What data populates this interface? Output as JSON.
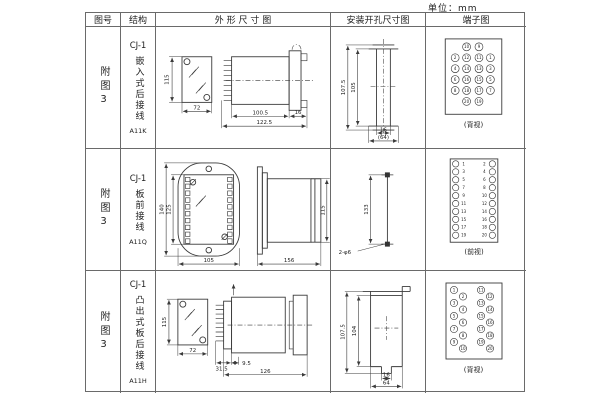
{
  "unit_label": "单位：mm",
  "header": {
    "figure": "图号",
    "structure": "结构",
    "outline": "外 形 尺 寸 图",
    "mounting": "安装开孔尺寸图",
    "terminal": "端子图"
  },
  "rows": [
    {
      "figure": "附图3",
      "model": "CJ-1",
      "desc": "嵌入式后接线",
      "code": "A11K",
      "outline": {
        "h": "115",
        "w": "72",
        "body": "100.5",
        "flange": "16",
        "total": "122.5"
      },
      "mounting": {
        "outer": "107.5",
        "inner": "105",
        "slot": "16",
        "overall": "(64)"
      },
      "terminal": {
        "label": "(背视)",
        "outer_left": [
          "2",
          "4",
          "6",
          "8"
        ],
        "inner_left": [
          "10",
          "12",
          "14",
          "16",
          "18",
          "20"
        ],
        "inner_right": [
          "9",
          "11",
          "13",
          "15",
          "17",
          "19"
        ],
        "outer_right": [
          "1",
          "3",
          "5",
          "7"
        ]
      }
    },
    {
      "figure": "附图3",
      "model": "CJ-1",
      "desc": "板前接线",
      "code": "A11Q",
      "outline": {
        "h": "140",
        "inner": "125",
        "w": "105",
        "len": "156",
        "side_h": "115"
      },
      "mounting": {
        "span": "133",
        "holes": "2-φ6"
      },
      "terminal": {
        "label": "(前视)",
        "left": [
          "1",
          "3",
          "5",
          "7",
          "9",
          "11",
          "13",
          "15",
          "17",
          "19"
        ],
        "right": [
          "2",
          "4",
          "6",
          "8",
          "10",
          "12",
          "14",
          "16",
          "18",
          "20"
        ]
      }
    },
    {
      "figure": "附图3",
      "model": "CJ-1",
      "desc": "凸出式板后接线",
      "code": "A11H",
      "outline": {
        "h": "115",
        "w": "72",
        "d1": "31.5",
        "d2": "9.5",
        "total": "126"
      },
      "mounting": {
        "outer": "107.5",
        "inner": "104",
        "slot": "16",
        "overall": "64"
      },
      "terminal": {
        "label": "(背视)",
        "colA": [
          "1",
          "3",
          "5",
          "7",
          "9"
        ],
        "colB": [
          "2",
          "4",
          "6",
          "8",
          "10"
        ],
        "colC": [
          "11",
          "13",
          "15",
          "17",
          "19"
        ],
        "colD": [
          "12",
          "14",
          "16",
          "18",
          "20"
        ]
      }
    }
  ]
}
